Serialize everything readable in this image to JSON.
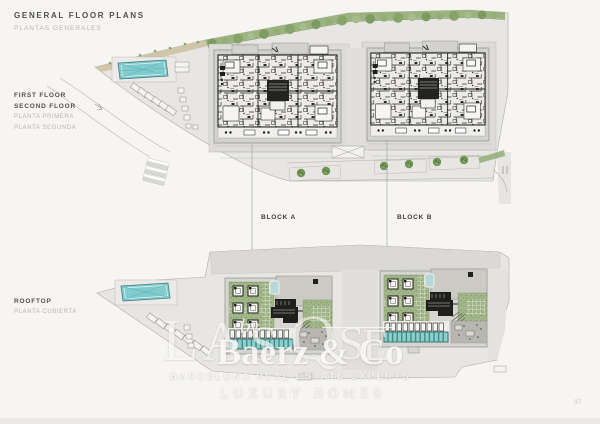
{
  "document": {
    "title": "GENERAL FLOOR PLANS",
    "subtitle": "PLANTAS GENERALES",
    "page_number": "37"
  },
  "upper_plan": {
    "labels_en": [
      "FIRST FLOOR",
      "SECOND FLOOR"
    ],
    "labels_es": [
      "PLANTA PRIMERA",
      "PLANTA SEGUNDA"
    ]
  },
  "lower_plan": {
    "labels_en": [
      "ROOFTOP"
    ],
    "labels_es": [
      "PLANTA CUBIERTA"
    ]
  },
  "blocks": {
    "a": "BLOCK A",
    "b": "BLOCK B"
  },
  "watermark": {
    "monogram_letters": [
      "L",
      "A",
      "S",
      "Q",
      "S",
      "E"
    ],
    "prefix": "by",
    "brand": "Baerz & Co",
    "tagline": "BARCELONA REAL ESTATE EXPERTS",
    "category": "LUXURY HOMES"
  },
  "colors": {
    "page-bg": "#f6f5f2",
    "text-dark": "#514f4b",
    "text-light": "#bab6b0",
    "label-dark": "#3d3c39",
    "watermark": "#faf9f6",
    "pool": "#7fcbce",
    "garden": "#a2b789",
    "tree": "#6f9455",
    "paving": "#e7e6e2",
    "building": "#d3d2ce",
    "ink": "#1f1f1c"
  }
}
